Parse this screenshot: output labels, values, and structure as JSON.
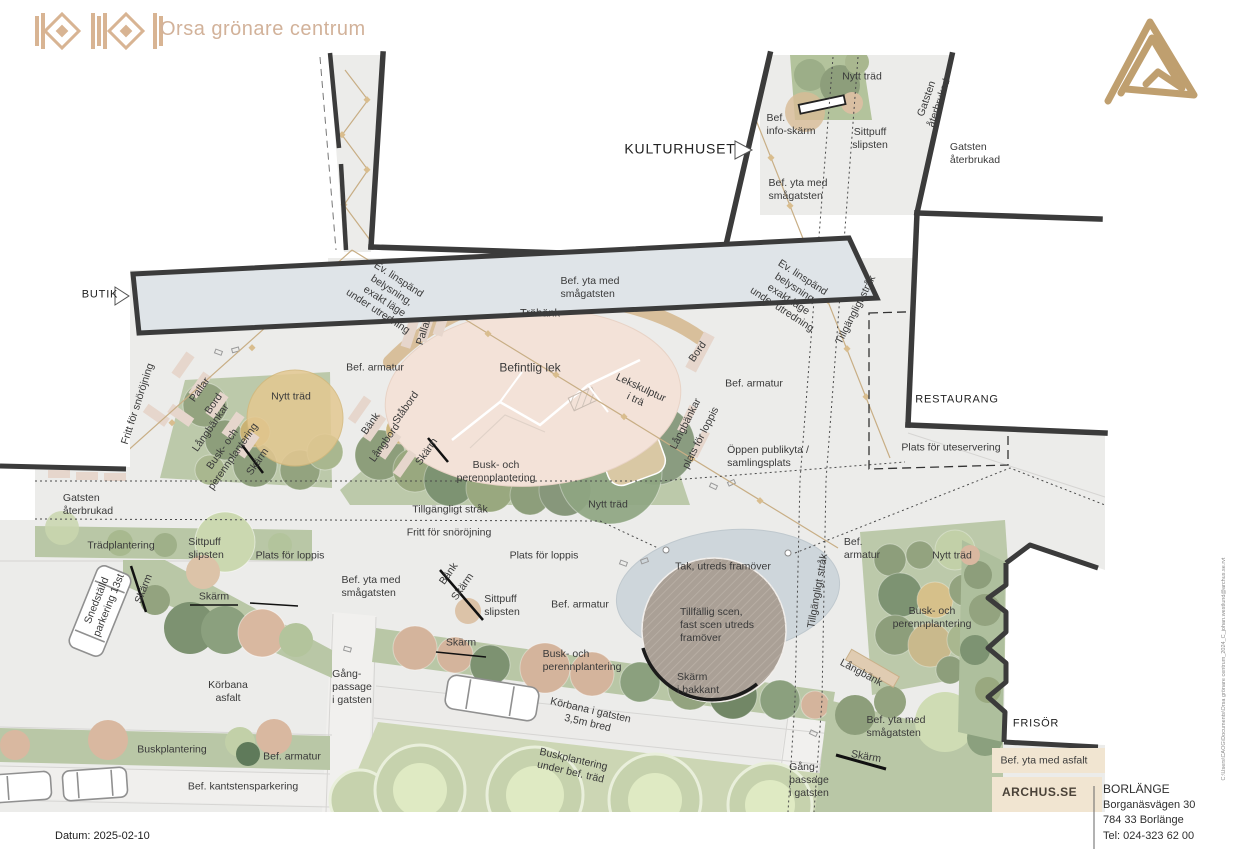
{
  "header": {
    "title": "Orsa grönare centrum"
  },
  "footer": {
    "datum": "Datum: 2025-02-10",
    "website": "ARCHUS.SE",
    "office": {
      "city": "BORLÄNGE",
      "street": "Borganäsvägen 30",
      "postal": "784 33 Borlänge",
      "phone": "Tel: 024-323 62 00"
    },
    "file_path": "C:\\Users\\CAOG\\Documents\\Orsa grönare centrum_2024_C_johan.westlund@archus.se.rvt"
  },
  "colors": {
    "accent_tan": "#d2b29a",
    "logo_gold": "#bf9f6f",
    "wall_dark": "#3b3b3b",
    "ground_gray": "#ececea",
    "planting_green": "#b9c7a6",
    "play_pink": "#f3e2d8",
    "bench_tan": "#d7bd97",
    "stage_blue": "#ccd5da",
    "stage_brown": "#aaa096"
  },
  "plan": {
    "labels": [
      {
        "id": "nytt-trad-topp",
        "t": "Nytt träd",
        "x": 862,
        "y": 77
      },
      {
        "id": "bef-info-skarm",
        "t": "Bef.\ninfo-skärm",
        "x": 791,
        "y": 125,
        "al": "left"
      },
      {
        "id": "sittpuff-slipsten-topp",
        "t": "Sittpuff\nslipsten",
        "x": 870,
        "y": 139
      },
      {
        "id": "gatsten-aterbrukad-strak",
        "t": "Gatsten\nåterbrukad",
        "x": 933,
        "y": 101,
        "r": -71
      },
      {
        "id": "kulturhuset",
        "t": "KULTURHUSET",
        "x": 680,
        "y": 149,
        "s": 14,
        "cls": "bld"
      },
      {
        "id": "gatsten-aterbrukad-ost",
        "t": "Gatsten\nåterbrukad",
        "x": 975,
        "y": 154,
        "al": "left"
      },
      {
        "id": "bef-yta-smagatsten-nord",
        "t": "Bef. yta med\nsmågatsten",
        "x": 798,
        "y": 190,
        "al": "left"
      },
      {
        "id": "ev-linspand-vast",
        "t": "Ev. linspänd\nbelysning,\nexakt läge\nunder utredning",
        "x": 388,
        "y": 296,
        "r": 33
      },
      {
        "id": "ev-linspand-ost",
        "t": "Ev. linspänd\nbelysning,\nexakt läge\nunder utredning",
        "x": 792,
        "y": 294,
        "r": 33
      },
      {
        "id": "tillgangligt-strak-nord",
        "t": "Tillgängligt stråk",
        "x": 856,
        "y": 310,
        "r": -63
      },
      {
        "id": "butik",
        "t": "BUTIK",
        "x": 100,
        "y": 295,
        "s": 11,
        "cls": "bld"
      },
      {
        "id": "fritt-snorojning-vast",
        "t": "Fritt för snöröjning",
        "x": 138,
        "y": 404,
        "r": -72
      },
      {
        "id": "pallar-vast",
        "t": "Pallar",
        "x": 200,
        "y": 390,
        "r": -55
      },
      {
        "id": "bord-vast",
        "t": "Bord",
        "x": 214,
        "y": 404,
        "r": -55
      },
      {
        "id": "langbankar-vast",
        "t": "Långbänkar",
        "x": 211,
        "y": 428,
        "r": -55
      },
      {
        "id": "busk-perenn-vast",
        "t": "Busk- och\nperennplantering",
        "x": 228,
        "y": 453,
        "r": -55
      },
      {
        "id": "skarm-vast",
        "t": "Skärm",
        "x": 258,
        "y": 462,
        "r": -55
      },
      {
        "id": "nytt-trad-vast",
        "t": "Nytt träd",
        "x": 291,
        "y": 397
      },
      {
        "id": "pallar-mitt",
        "t": "Pallar",
        "x": 424,
        "y": 332,
        "r": -72
      },
      {
        "id": "trabank",
        "t": "Träbänk",
        "x": 540,
        "y": 314,
        "s": 11
      },
      {
        "id": "bef-yta-smagatsten-mitt",
        "t": "Bef. yta med\nsmågatsten",
        "x": 590,
        "y": 288,
        "al": "left"
      },
      {
        "id": "bef-armatur-1",
        "t": "Bef. armatur",
        "x": 375,
        "y": 368
      },
      {
        "id": "befintlig-lek",
        "t": "Befintlig lek",
        "x": 530,
        "y": 368,
        "s": 12
      },
      {
        "id": "lekskulptur",
        "t": "Lekskulptur\ni trä",
        "x": 638,
        "y": 394,
        "r": 25
      },
      {
        "id": "bank-mitt",
        "t": "Bänk",
        "x": 371,
        "y": 424,
        "r": -55
      },
      {
        "id": "langbord-mitt",
        "t": "Långbord",
        "x": 385,
        "y": 443,
        "r": -55
      },
      {
        "id": "stabord-mitt",
        "t": "Ståbord",
        "x": 406,
        "y": 408,
        "r": -55
      },
      {
        "id": "skarm-mitt",
        "t": "Skärm",
        "x": 427,
        "y": 452,
        "r": -55
      },
      {
        "id": "busk-perenn-mitt",
        "t": "Busk- och\nperennplantering",
        "x": 496,
        "y": 472
      },
      {
        "id": "bord-ost",
        "t": "Bord",
        "x": 698,
        "y": 352,
        "r": -55
      },
      {
        "id": "bef-armatur-2",
        "t": "Bef. armatur",
        "x": 754,
        "y": 384
      },
      {
        "id": "langbankar-ost",
        "t": "Långbänkar",
        "x": 686,
        "y": 424,
        "r": -63
      },
      {
        "id": "plats-loppis-rot",
        "t": "plats för loppis",
        "x": 701,
        "y": 438,
        "r": -63
      },
      {
        "id": "oppen-publikyta",
        "t": "Öppen publikyta /\nsamlingsplats",
        "x": 768,
        "y": 457,
        "al": "left"
      },
      {
        "id": "restaurang",
        "t": "RESTAURANG",
        "x": 957,
        "y": 400,
        "s": 11,
        "cls": "bld"
      },
      {
        "id": "plats-uteservering",
        "t": "Plats för uteservering",
        "x": 951,
        "y": 448
      },
      {
        "id": "gatsten-aterbrukad-vast",
        "t": "Gatsten\nåterbrukad",
        "x": 88,
        "y": 505,
        "al": "left"
      },
      {
        "id": "tillgangligt-strak-mitt",
        "t": "Tillgängligt stråk",
        "x": 450,
        "y": 510
      },
      {
        "id": "nytt-trad-mitt",
        "t": "Nytt träd",
        "x": 608,
        "y": 505
      },
      {
        "id": "fritt-snorojning-mitt",
        "t": "Fritt för snöröjning",
        "x": 449,
        "y": 533
      },
      {
        "id": "tradplantering",
        "t": "Trädplantering",
        "x": 121,
        "y": 546
      },
      {
        "id": "sittpuff-slipsten-vast",
        "t": "Sittpuff\nslipsten",
        "x": 206,
        "y": 549,
        "al": "left"
      },
      {
        "id": "plats-loppis-vast",
        "t": "Plats för loppis",
        "x": 290,
        "y": 556
      },
      {
        "id": "plats-loppis-mitt",
        "t": "Plats för loppis",
        "x": 544,
        "y": 556
      },
      {
        "id": "bef-armatur-kolumn",
        "t": "Bef.\narmatur",
        "x": 862,
        "y": 549,
        "al": "left"
      },
      {
        "id": "nytt-trad-ost",
        "t": "Nytt träd",
        "x": 952,
        "y": 556
      },
      {
        "id": "snedstalld-parkering",
        "t": "Snedställd\nparkering 13st",
        "x": 103,
        "y": 603,
        "r": -68
      },
      {
        "id": "skarm-parkering",
        "t": "Skärm",
        "x": 144,
        "y": 589,
        "r": -68
      },
      {
        "id": "skarm-understruken-1",
        "t": "Skärm",
        "x": 214,
        "y": 597
      },
      {
        "id": "bef-yta-smagatsten-vast",
        "t": "Bef. yta med\nsmågatsten",
        "x": 371,
        "y": 587,
        "al": "left"
      },
      {
        "id": "bank-liten",
        "t": "Bänk",
        "x": 449,
        "y": 574,
        "r": -55
      },
      {
        "id": "skarm-liten",
        "t": "Skärm",
        "x": 463,
        "y": 587,
        "r": -55
      },
      {
        "id": "sittpuff-slipsten-mitt",
        "t": "Sittpuff\nslipsten",
        "x": 502,
        "y": 606,
        "al": "left"
      },
      {
        "id": "bef-armatur-3",
        "t": "Bef. armatur",
        "x": 580,
        "y": 605
      },
      {
        "id": "tak-utreds",
        "t": "Tak, utreds framöver",
        "x": 723,
        "y": 567
      },
      {
        "id": "tillgangligt-strak-syd",
        "t": "Tillgängligt stråk",
        "x": 818,
        "y": 591,
        "r": -80
      },
      {
        "id": "busk-perenn-ost",
        "t": "Busk- och\nperennplantering",
        "x": 932,
        "y": 618
      },
      {
        "id": "tillfallig-scen",
        "t": "Tillfällig scen,\nfast scen utreds\nframöver",
        "x": 717,
        "y": 625,
        "al": "left"
      },
      {
        "id": "skarm-bakkant",
        "t": "Skärm\ni bakkant",
        "x": 698,
        "y": 684,
        "al": "left"
      },
      {
        "id": "langbank-ost",
        "t": "Långbänk",
        "x": 861,
        "y": 673,
        "r": 28
      },
      {
        "id": "korbana-asfalt",
        "t": "Körbana\nasfalt",
        "x": 228,
        "y": 692
      },
      {
        "id": "gang-passage-vast",
        "t": "Gång-\npassage\ni gatsten",
        "x": 352,
        "y": 687,
        "al": "left"
      },
      {
        "id": "skarm-understruken-2",
        "t": "Skärm",
        "x": 461,
        "y": 643
      },
      {
        "id": "busk-perenn-syd",
        "t": "Busk- och\nperennplantering",
        "x": 582,
        "y": 661,
        "al": "left"
      },
      {
        "id": "korbana-gatsten",
        "t": "Körbana i gatsten\n3,5m bred",
        "x": 589,
        "y": 717,
        "r": 13
      },
      {
        "id": "buskplantering",
        "t": "Buskplantering",
        "x": 172,
        "y": 750
      },
      {
        "id": "bef-armatur-4",
        "t": "Bef. armatur",
        "x": 292,
        "y": 757
      },
      {
        "id": "buskplantering-trad",
        "t": "Buskplantering\nunder bef. träd",
        "x": 572,
        "y": 766,
        "r": 13
      },
      {
        "id": "bef-kantstensparkering",
        "t": "Bef. kantstensparkering",
        "x": 243,
        "y": 787
      },
      {
        "id": "gang-passage-ost",
        "t": "Gång-\npassage\ni gatsten",
        "x": 809,
        "y": 780,
        "al": "left"
      },
      {
        "id": "bef-yta-smagatsten-ost",
        "t": "Bef. yta med\nsmågatsten",
        "x": 896,
        "y": 727,
        "al": "left"
      },
      {
        "id": "skarm-ost",
        "t": "Skärm",
        "x": 866,
        "y": 757,
        "r": 10
      },
      {
        "id": "bef-yta-asfalt",
        "t": "Bef. yta med asfalt",
        "x": 1044,
        "y": 761
      },
      {
        "id": "frisor",
        "t": "FRISÖR",
        "x": 1036,
        "y": 724,
        "s": 11,
        "cls": "bld"
      }
    ]
  }
}
